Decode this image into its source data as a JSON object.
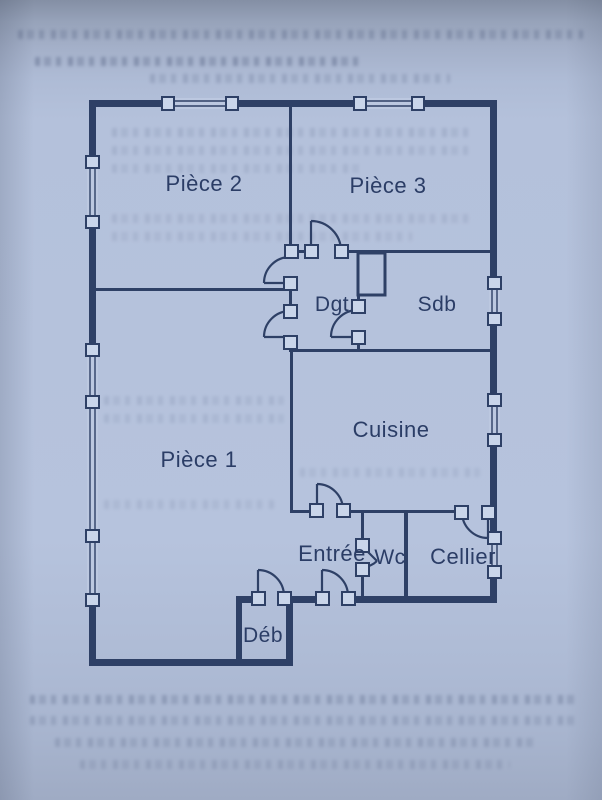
{
  "diagram": {
    "type": "floor-plan",
    "orientation": "scanned page, plan of an apartment",
    "door_count": 9,
    "window_count": 7
  },
  "rooms": [
    {
      "id": "piece-2",
      "label": "Pièce 2"
    },
    {
      "id": "piece-3",
      "label": "Pièce 3"
    },
    {
      "id": "degagement",
      "label": "Dgt"
    },
    {
      "id": "salle-de-bains",
      "label": "Sdb"
    },
    {
      "id": "cuisine",
      "label": "Cuisine"
    },
    {
      "id": "piece-1",
      "label": "Pièce 1"
    },
    {
      "id": "entree",
      "label": "Entrée"
    },
    {
      "id": "wc",
      "label": "Wc"
    },
    {
      "id": "cellier",
      "label": "Cellier"
    },
    {
      "id": "debarras",
      "label": "Déb"
    }
  ],
  "colors": {
    "paper": "#b4c1db",
    "ink": "#2e4066",
    "label_text": "#2b3d66",
    "jamb_fill": "#c9d5ea"
  }
}
